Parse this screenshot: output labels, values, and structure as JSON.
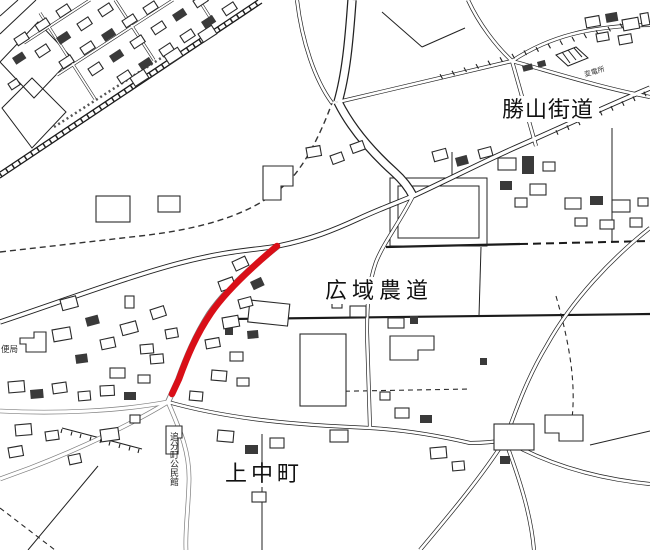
{
  "map": {
    "type": "monochrome-city-map",
    "labels": {
      "katsuyama_kaido": "勝山街道",
      "koiki_nodo": "広域農道",
      "kaminaka_cho": "上中町",
      "community_center_vertical": "追分町公民館",
      "post_office_partial": "便局",
      "substation": "変電所"
    },
    "highlight": {
      "path": "M277,246 C252,267 226,291 211,313 C196,335 187,357 179,379 L172,394",
      "color": "#d90f18",
      "width": 6.5
    },
    "colors": {
      "background": "#ffffff",
      "line": "#222222",
      "minor_road": "#7d7d7d"
    }
  }
}
